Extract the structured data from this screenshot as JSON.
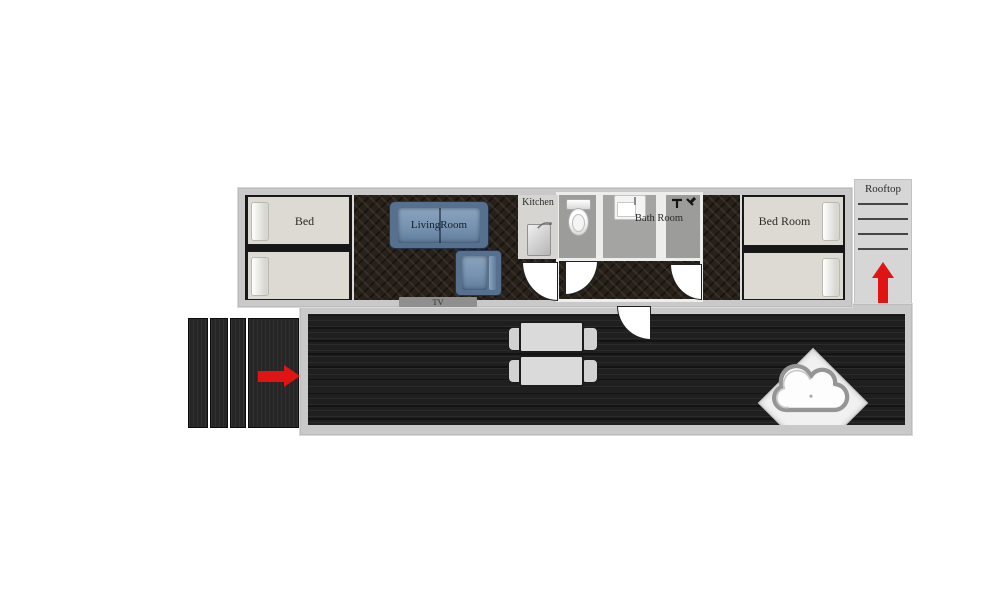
{
  "labels": {
    "bed_left": "Bed",
    "living_room": "LivingRoom",
    "tv": "TV",
    "kitchen": "Kitchen",
    "bath_room": "Bath Room",
    "bed_right": "Bed Room",
    "rooftop": "Rooftop"
  },
  "colors": {
    "wall_gray": "#c9c9c9",
    "bed_cream": "#dcdad2",
    "dark_floor": "#27211b",
    "deck_wood": "#1f1f1f",
    "bath_floor": "#9c9c9a",
    "kitchen_floor": "#d6d5d1",
    "sofa_blue": "#7491af",
    "arrow_red": "#e01414",
    "tv_bar": "#8f8f8f",
    "rooftop_bg": "#d6d6d6"
  },
  "counts": {
    "beds_left_room": 2,
    "beds_right_room": 2,
    "rooftop_step_lines": 4,
    "entry_stair_planks": 4,
    "deck_tables": 2,
    "deck_chairs": 4,
    "door_swings": 4
  },
  "icons": {
    "toilet": "toilet-icon",
    "bathroom_sink": "sink-icon",
    "kitchen_sink": "kitchen-sink-icon",
    "shower": "shower-icon",
    "sofa": "sofa-icon",
    "armchair": "armchair-icon",
    "hot_tub": "cloud-hot-tub-icon",
    "rooftop_arrow": "up-arrow-icon",
    "entry_arrow": "right-arrow-icon"
  }
}
